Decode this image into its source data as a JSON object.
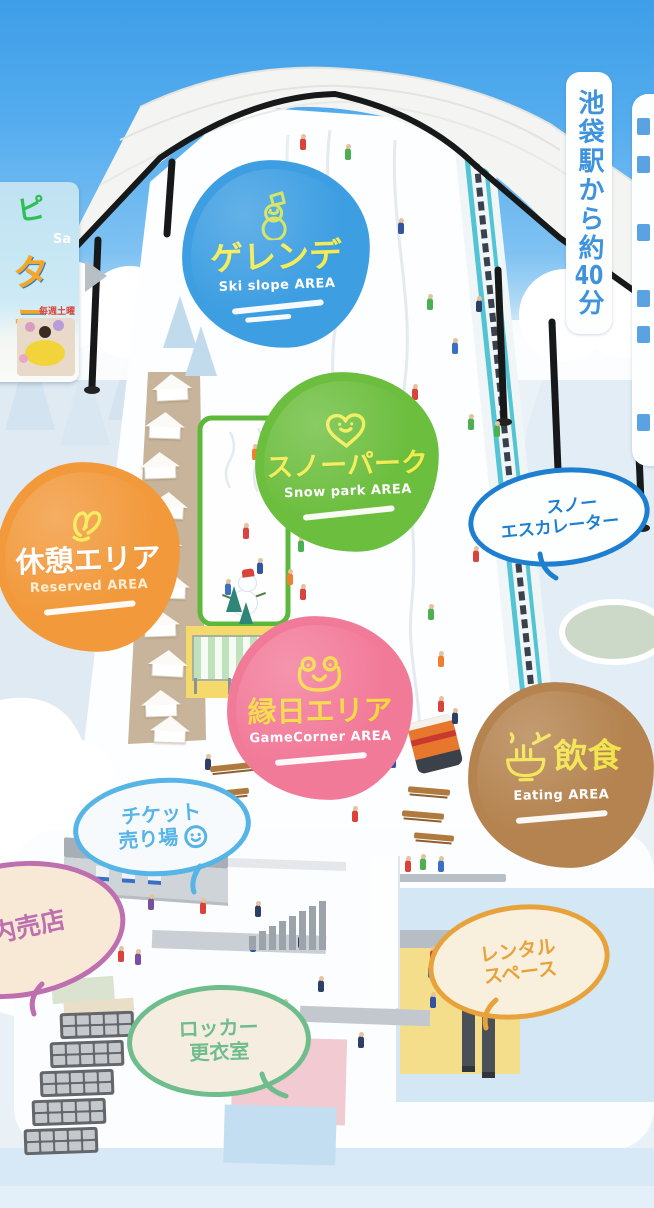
{
  "areas": {
    "ski_slope": {
      "title": "ゲレンデ",
      "subtitle": "Ski slope AREA",
      "color": "#3D9EE2",
      "title_color": "#F2EC4F",
      "subtitle_color": "#FFFFFF",
      "icon": "snowman-icon",
      "icon_color": "#CEE24E"
    },
    "snow_park": {
      "title": "スノーパーク",
      "subtitle": "Snow park AREA",
      "color": "#6CBE3E",
      "title_color": "#F2EC4F",
      "subtitle_color": "#FFFFFF",
      "icon": "heart-icon",
      "icon_color": "#F2EC4F"
    },
    "rest": {
      "title": "休憩エリア",
      "subtitle": "Reserved AREA",
      "color": "#F2993B",
      "title_color": "#FFFFFF",
      "subtitle_color": "#FBEDD2",
      "icon": "rabbit-icon",
      "icon_color": "#F5E94C"
    },
    "game_corner": {
      "title": "縁日エリア",
      "subtitle": "GameCorner AREA",
      "color": "#F27A99",
      "title_color": "#F5D83E",
      "subtitle_color": "#FFFFFF",
      "icon": "frog-icon",
      "icon_color": "#F5D83E"
    },
    "eating": {
      "title": "飲食",
      "subtitle": "Eating AREA",
      "color": "#B4834F",
      "title_color": "#F2E34A",
      "subtitle_color": "#FFFFFF",
      "icon": "ramen-icon",
      "icon_color": "#F2E34A"
    }
  },
  "bubbles": {
    "snow_escalator": {
      "line1": "スノー",
      "line2": "エスカレーター",
      "color": "#1E7FD0",
      "fill": "#FDFEFE"
    },
    "ticket_counter": {
      "line1": "チケット",
      "line2": "売り場",
      "color": "#56B4E6",
      "fill": "#F6FAFC",
      "icon": "smiley-icon"
    },
    "shop": {
      "line1": "内売店",
      "color": "#BD6FB0",
      "fill": "#F7E9D6"
    },
    "rental_space": {
      "line1": "レンタル",
      "line2": "スペース",
      "color": "#E8A23C",
      "fill": "#F8F0DC"
    },
    "locker_room": {
      "line1": "ロッカー",
      "line2": "更衣室",
      "color": "#6FBD8D",
      "fill": "#F5EDE0"
    }
  },
  "signs": {
    "access": {
      "prefix": "池袋駅から約",
      "number": "40",
      "suffix": "分",
      "color": "#3E92DE"
    },
    "partial_right": {
      "color": "#3E92DE"
    }
  },
  "poster": {
    "frag_top": "ピ",
    "frag_mid": "Sa",
    "frag_title": "タテ",
    "frag_small": "毎週土曜",
    "arrow_color": "#B9BFC6"
  },
  "decorations": {
    "people": [
      [
        300,
        138,
        "#D8433C"
      ],
      [
        345,
        148,
        "#4CAF50"
      ],
      [
        398,
        222,
        "#33549E"
      ],
      [
        262,
        318,
        "#F07F2E"
      ],
      [
        427,
        298,
        "#4CAF50"
      ],
      [
        452,
        342,
        "#3A6FC4"
      ],
      [
        412,
        388,
        "#D8433C"
      ],
      [
        468,
        418,
        "#4CAF50"
      ],
      [
        428,
        478,
        "#2E3F66"
      ],
      [
        473,
        550,
        "#D8433C"
      ],
      [
        428,
        608,
        "#4CAF50"
      ],
      [
        438,
        655,
        "#F07F2E"
      ],
      [
        438,
        700,
        "#D8433C"
      ],
      [
        452,
        712,
        "#2E3F66"
      ],
      [
        476,
        300,
        "#2E3F66"
      ],
      [
        494,
        425,
        "#4CAF50"
      ],
      [
        252,
        448,
        "#F07F2E"
      ],
      [
        268,
        487,
        "#3A6FC4"
      ],
      [
        243,
        527,
        "#D8433C"
      ],
      [
        298,
        540,
        "#4CAF50"
      ],
      [
        257,
        562,
        "#33549E"
      ],
      [
        287,
        573,
        "#F07F2E"
      ],
      [
        225,
        583,
        "#3A6FC4"
      ],
      [
        300,
        588,
        "#D8433C"
      ],
      [
        205,
        758,
        "#2E3F66"
      ],
      [
        352,
        810,
        "#D8433C"
      ],
      [
        390,
        756,
        "#33549E"
      ],
      [
        148,
        898,
        "#7A4FA0"
      ],
      [
        200,
        902,
        "#D8433C"
      ],
      [
        255,
        905,
        "#2E3F66"
      ],
      [
        118,
        950,
        "#D8433C"
      ],
      [
        135,
        953,
        "#7A4FA0"
      ],
      [
        250,
        940,
        "#33549E"
      ],
      [
        298,
        936,
        "#2E3F66"
      ],
      [
        358,
        1036,
        "#2E3F66"
      ],
      [
        95,
        1026,
        "#2E3F66"
      ],
      [
        150,
        1066,
        "#C8A050"
      ],
      [
        318,
        980,
        "#2E3F66"
      ],
      [
        282,
        1003,
        "#4CAF50"
      ],
      [
        430,
        950,
        "#D8433C"
      ],
      [
        468,
        930,
        "#E8C832"
      ],
      [
        428,
        966,
        "#3A6FC4"
      ],
      [
        462,
        970,
        "#2E3F66"
      ],
      [
        430,
        996,
        "#33549E"
      ],
      [
        505,
        980,
        "#3A6FC4"
      ],
      [
        405,
        860,
        "#D8433C"
      ],
      [
        420,
        858,
        "#4CAF50"
      ],
      [
        438,
        860,
        "#3A6FC4"
      ]
    ],
    "tents": [
      [
        152,
        374,
        -3
      ],
      [
        145,
        412,
        2
      ],
      [
        140,
        452,
        -2
      ],
      [
        148,
        492,
        3
      ],
      [
        142,
        532,
        -3
      ],
      [
        150,
        572,
        2
      ],
      [
        140,
        610,
        -2
      ],
      [
        148,
        650,
        3
      ],
      [
        141,
        690,
        -2
      ],
      [
        150,
        716,
        2
      ]
    ],
    "benches": [
      [
        210,
        764,
        46,
        -6
      ],
      [
        203,
        790,
        46,
        -6
      ],
      [
        408,
        788,
        42,
        5
      ],
      [
        402,
        812,
        42,
        5
      ],
      [
        414,
        834,
        40,
        5
      ]
    ],
    "lockers": [
      [
        60,
        1012
      ],
      [
        50,
        1041
      ],
      [
        40,
        1070
      ],
      [
        32,
        1099
      ],
      [
        24,
        1128
      ]
    ],
    "stairs": {
      "x": 249,
      "y_base": 950,
      "count": 8
    },
    "trees": [
      [
        163,
        296,
        52,
        "#C2DBEC"
      ],
      [
        185,
        326,
        50,
        "#C2DBEC"
      ],
      [
        226,
        586,
        26,
        "#2E8578"
      ],
      [
        239,
        602,
        22,
        "#2E8578"
      ]
    ]
  }
}
